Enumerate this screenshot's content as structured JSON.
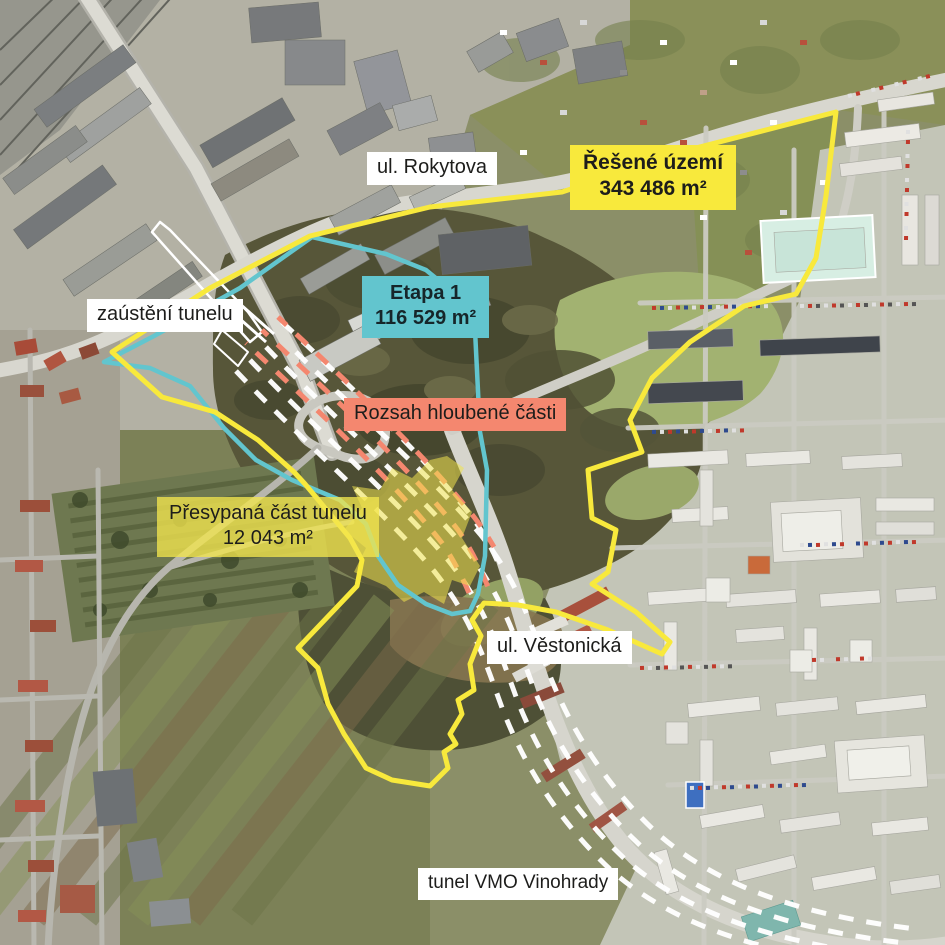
{
  "labels": {
    "rokytova": "ul. Rokytova",
    "resene_uzemi_title": "Řešené území",
    "resene_uzemi_area": "343 486 m²",
    "etapa1_title": "Etapa 1",
    "etapa1_area": "116 529 m²",
    "zausteni": "zaústění tunelu",
    "rozsah": "Rozsah hloubené části",
    "presypana_title": "Přesypaná část tunelu",
    "presypana_area": "12 043 m²",
    "vestonicka": "ul. Věstonická",
    "tunel_vmo": "tunel VMO Vinohrady"
  },
  "legend_colors": {
    "resene_uzemi_yellow": "#f8e93c",
    "etapa1_teal": "#62c5ce",
    "hloubena_salmon": "#f4876f",
    "tunnel_route_white": "#ffffff",
    "presypana_fill_yellow": "#f0e44e",
    "label_text": "#1d1d1b"
  }
}
